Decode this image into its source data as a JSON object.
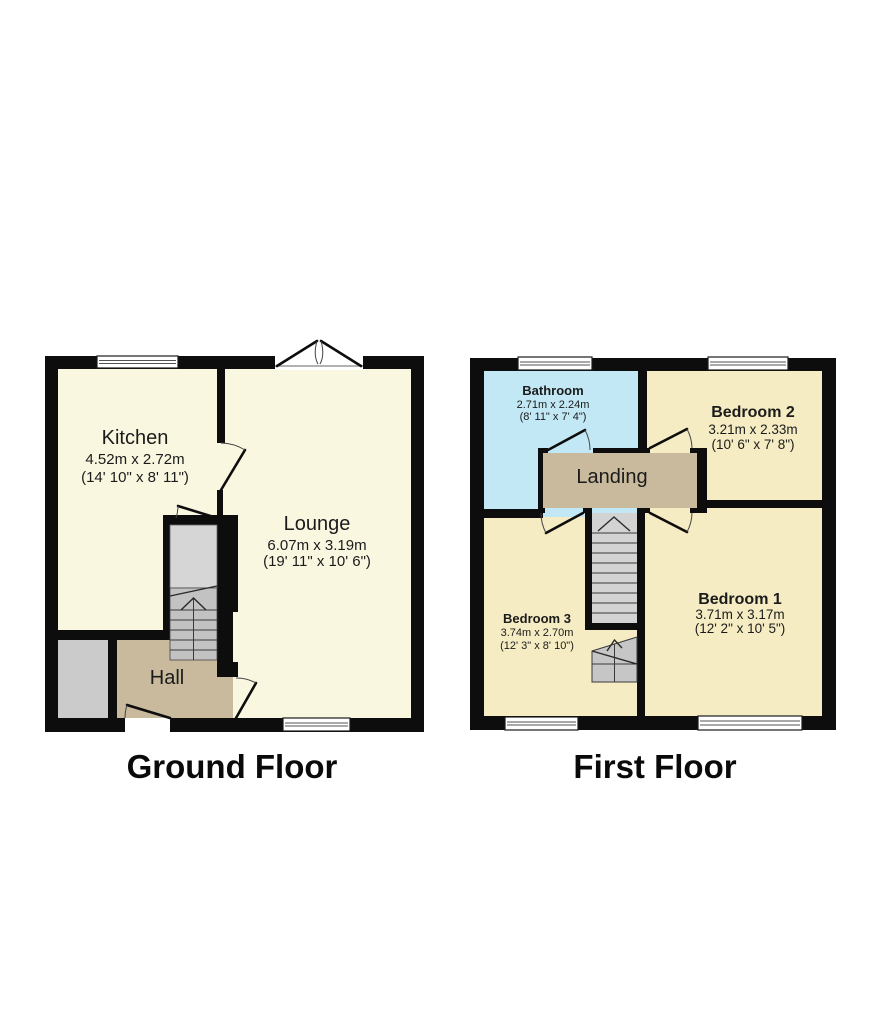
{
  "document": {
    "type": "floorplan",
    "background": "#ffffff"
  },
  "colors": {
    "wall": "#0d0d0d",
    "ground_room": "#faf7e1",
    "first_room": "#f5ecc3",
    "hall_landing_tan": "#c9ba9d",
    "bathroom_blue": "#c2e8f5",
    "porch_gray": "#cbcbcb",
    "cupboard_gray": "#d6d6d6",
    "stairs_gray": "#c2c2c2",
    "first_stairs_gray": "#d3d3d3",
    "winder_gray": "#c6c6c6",
    "text": "#1b1b1b"
  },
  "plans": [
    {
      "id": "ground-floor",
      "label": "Ground Floor",
      "rooms": [
        {
          "name": "Kitchen",
          "metric": "4.52m x 2.72m",
          "imperial": "(14' 10\" x 8' 11\")"
        },
        {
          "name": "Lounge",
          "metric": "6.07m x 3.19m",
          "imperial": "(19' 11\" x 10' 6\")"
        },
        {
          "name": "Hall",
          "metric": "",
          "imperial": ""
        }
      ],
      "features": [
        "front-door",
        "french-doors",
        "kitchen-window",
        "lounge-window",
        "staircase-up",
        "understairs-cupboard",
        "store"
      ]
    },
    {
      "id": "first-floor",
      "label": "First Floor",
      "rooms": [
        {
          "name": "Bathroom",
          "metric": "2.71m x 2.24m",
          "imperial": "(8' 11\" x 7' 4\")"
        },
        {
          "name": "Bedroom 2",
          "metric": "3.21m x 2.33m",
          "imperial": "(10' 6\" x 7' 8\")"
        },
        {
          "name": "Landing",
          "metric": "",
          "imperial": ""
        },
        {
          "name": "Bedroom 3",
          "metric": "3.74m x 2.70m",
          "imperial": "(12' 3\" x 8' 10\")"
        },
        {
          "name": "Bedroom 1",
          "metric": "3.71m x 3.17m",
          "imperial": "(12' 2\" x 10' 5\")"
        }
      ],
      "features": [
        "bathroom-window",
        "bedroom2-window",
        "bedroom3-window",
        "bedroom1-window",
        "staircase-down"
      ]
    }
  ]
}
